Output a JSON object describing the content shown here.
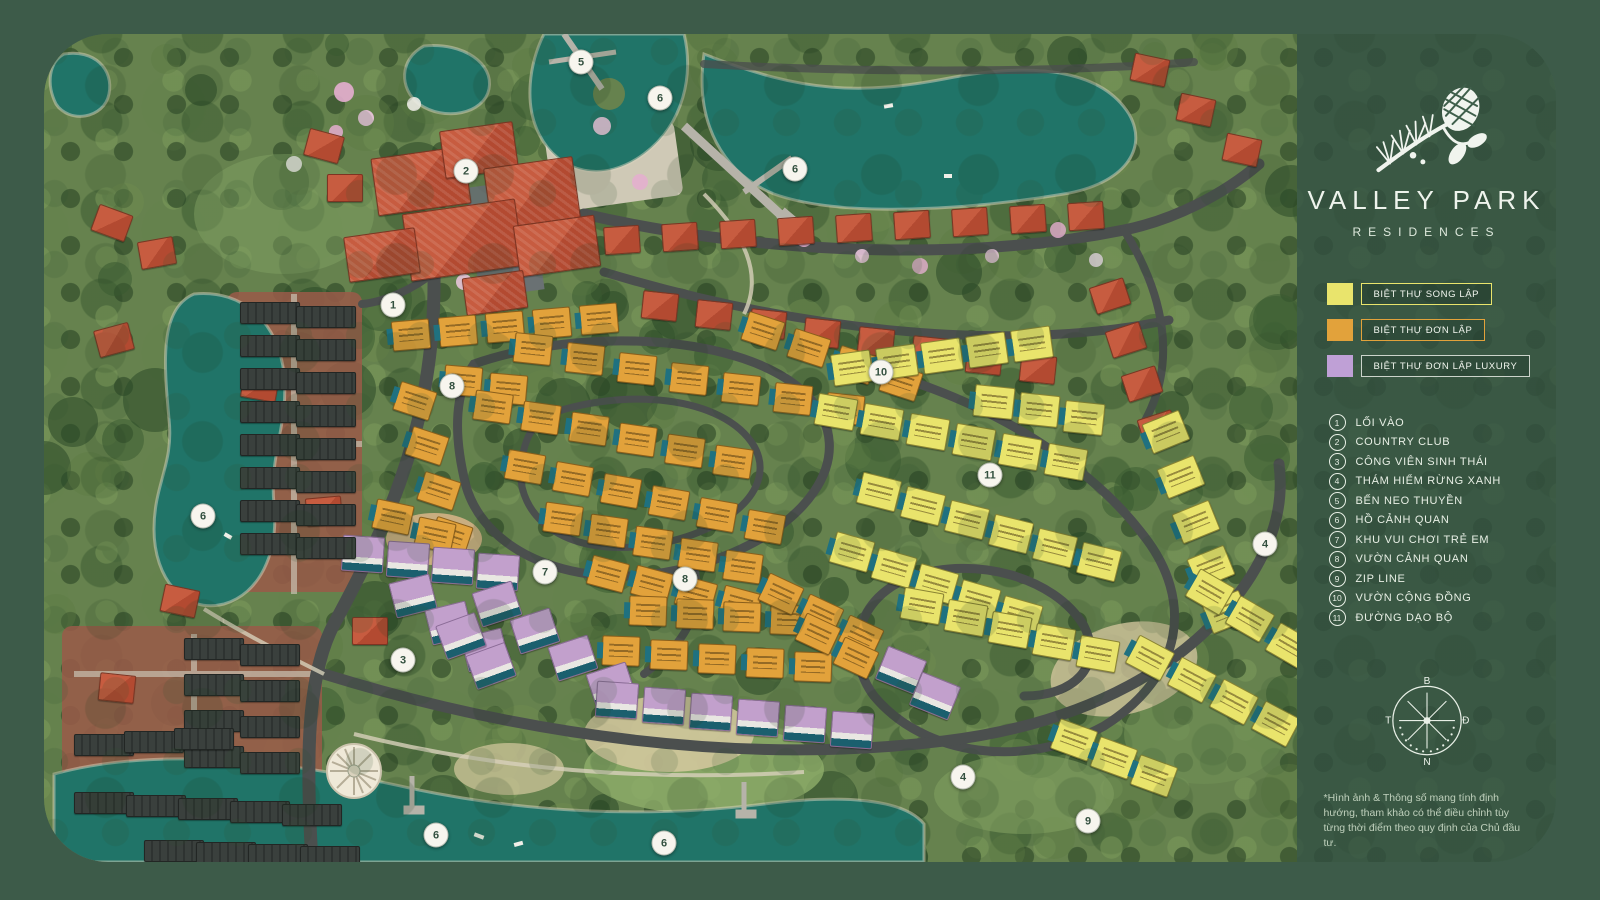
{
  "brand": {
    "logo": "pine-branch-and-cone",
    "title": "VALLEY PARK",
    "subtitle": "RESIDENCES"
  },
  "legend": [
    {
      "label": "BIỆT THỰ SONG LẬP",
      "color": "#e9e46c",
      "border": "#e9e46c"
    },
    {
      "label": "BIỆT THỰ ĐƠN LẬP",
      "color": "#e2a23b",
      "border": "#e2a23b"
    },
    {
      "label": "BIỆT THỰ ĐƠN LẬP LUXURY",
      "color": "#bfa0d6",
      "border": "#ccd4cb"
    }
  ],
  "locations": [
    {
      "num": "1",
      "label": "LỐI VÀO"
    },
    {
      "num": "2",
      "label": "COUNTRY CLUB"
    },
    {
      "num": "3",
      "label": "CÔNG VIÊN SINH THÁI"
    },
    {
      "num": "4",
      "label": "THÁM HIỂM RỪNG XANH"
    },
    {
      "num": "5",
      "label": "BẾN NEO THUYỀN"
    },
    {
      "num": "6",
      "label": "HỒ CẢNH QUAN"
    },
    {
      "num": "7",
      "label": "KHU VUI CHƠI TRẺ EM"
    },
    {
      "num": "8",
      "label": "VƯỜN CẢNH QUAN"
    },
    {
      "num": "9",
      "label": "ZIP LINE"
    },
    {
      "num": "10",
      "label": "VƯỜN CỘNG ĐỒNG"
    },
    {
      "num": "11",
      "label": "ĐƯỜNG DẠO BỘ"
    }
  ],
  "compass": {
    "north": "B",
    "east": "Đ",
    "south": "N",
    "west": "T"
  },
  "disclaimer": "*Hình ảnh & Thông số mang tính định hướng, tham khảo có thể điều chỉnh tùy từng thời điểm theo quy định của Chủ đầu tư.",
  "map": {
    "plot_id_examples": [
      "BT02",
      "BT03",
      "BT04",
      "BT05",
      "BT10",
      "BT12",
      "BT13",
      "BT16",
      "BT17"
    ],
    "markers": [
      {
        "n": "1",
        "x": 349,
        "y": 271
      },
      {
        "n": "2",
        "x": 422,
        "y": 137
      },
      {
        "n": "3",
        "x": 359,
        "y": 626
      },
      {
        "n": "4",
        "x": 1221,
        "y": 510
      },
      {
        "n": "4",
        "x": 919,
        "y": 743
      },
      {
        "n": "5",
        "x": 537,
        "y": 28
      },
      {
        "n": "6",
        "x": 616,
        "y": 64
      },
      {
        "n": "6",
        "x": 751,
        "y": 135
      },
      {
        "n": "6",
        "x": 159,
        "y": 482
      },
      {
        "n": "6",
        "x": 392,
        "y": 801
      },
      {
        "n": "6",
        "x": 620,
        "y": 809
      },
      {
        "n": "7",
        "x": 501,
        "y": 538
      },
      {
        "n": "8",
        "x": 408,
        "y": 352
      },
      {
        "n": "8",
        "x": 641,
        "y": 545
      },
      {
        "n": "9",
        "x": 1044,
        "y": 787
      },
      {
        "n": "10",
        "x": 837,
        "y": 338
      },
      {
        "n": "11",
        "x": 946,
        "y": 441
      }
    ],
    "strips": [
      {
        "c": "r",
        "x": 560,
        "y": 192,
        "dx": 58,
        "dy": -3,
        "n": 9,
        "r": -4
      },
      {
        "c": "r",
        "x": 598,
        "y": 258,
        "dx": 54,
        "dy": 9,
        "n": 8,
        "r": 6
      },
      {
        "c": "r",
        "x": 1048,
        "y": 248,
        "dx": 16,
        "dy": 44,
        "n": 4,
        "r": -18
      },
      {
        "c": "r",
        "x": 1088,
        "y": 22,
        "dx": 46,
        "dy": 40,
        "n": 3,
        "r": 12
      },
      {
        "c": "r",
        "x": 50,
        "y": 175,
        "dx": 0,
        "dy": 0,
        "n": 1,
        "r": 20
      },
      {
        "c": "r",
        "x": 95,
        "y": 205,
        "dx": 0,
        "dy": 0,
        "n": 1,
        "r": -10
      },
      {
        "c": "r",
        "x": 262,
        "y": 98,
        "dx": 0,
        "dy": 0,
        "n": 1,
        "r": 15
      },
      {
        "c": "r",
        "x": 283,
        "y": 140,
        "dx": 0,
        "dy": 0,
        "n": 1,
        "r": 0
      },
      {
        "c": "r",
        "x": 52,
        "y": 292,
        "dx": 0,
        "dy": 0,
        "n": 1,
        "r": -15
      },
      {
        "c": "r",
        "x": 198,
        "y": 338,
        "dx": 0,
        "dy": 0,
        "n": 1,
        "r": 10
      },
      {
        "c": "r",
        "x": 262,
        "y": 463,
        "dx": 0,
        "dy": 0,
        "n": 1,
        "r": -5
      },
      {
        "c": "r",
        "x": 118,
        "y": 553,
        "dx": 0,
        "dy": 0,
        "n": 1,
        "r": 12
      },
      {
        "c": "r",
        "x": 308,
        "y": 583,
        "dx": 0,
        "dy": 0,
        "n": 1,
        "r": 0
      },
      {
        "c": "r",
        "x": 150,
        "y": 688,
        "dx": 0,
        "dy": 0,
        "n": 1,
        "r": -8
      },
      {
        "c": "r",
        "x": 55,
        "y": 640,
        "dx": 0,
        "dy": 0,
        "n": 1,
        "r": 6
      },
      {
        "c": "c",
        "x": 330,
        "y": 118,
        "dx": 0,
        "dy": 0,
        "n": 1,
        "r": -8,
        "w": 92,
        "h": 56
      },
      {
        "c": "c",
        "x": 398,
        "y": 92,
        "dx": 0,
        "dy": 0,
        "n": 1,
        "r": -8,
        "w": 72,
        "h": 46
      },
      {
        "c": "c",
        "x": 443,
        "y": 128,
        "dx": 0,
        "dy": 0,
        "n": 1,
        "r": -8,
        "w": 88,
        "h": 60
      },
      {
        "c": "c",
        "x": 362,
        "y": 172,
        "dx": 0,
        "dy": 0,
        "n": 1,
        "r": -8,
        "w": 112,
        "h": 66
      },
      {
        "c": "c",
        "x": 472,
        "y": 186,
        "dx": 0,
        "dy": 0,
        "n": 1,
        "r": -8,
        "w": 80,
        "h": 50
      },
      {
        "c": "c",
        "x": 302,
        "y": 198,
        "dx": 0,
        "dy": 0,
        "n": 1,
        "r": -8,
        "w": 70,
        "h": 44
      },
      {
        "c": "c",
        "x": 420,
        "y": 240,
        "dx": 0,
        "dy": 0,
        "n": 1,
        "r": -8,
        "w": 60,
        "h": 36
      },
      {
        "c": "o",
        "x": 348,
        "y": 286,
        "dx": 47,
        "dy": -4,
        "n": 5,
        "r": -5
      },
      {
        "c": "o",
        "x": 400,
        "y": 332,
        "dx": 45,
        "dy": 8,
        "n": 2,
        "r": 5
      },
      {
        "c": "o",
        "x": 352,
        "y": 352,
        "dx": 12,
        "dy": 45,
        "n": 4,
        "r": 18
      },
      {
        "c": "o",
        "x": 470,
        "y": 300,
        "dx": 52,
        "dy": 10,
        "n": 7,
        "r": 6
      },
      {
        "c": "o",
        "x": 430,
        "y": 358,
        "dx": 48,
        "dy": 11,
        "n": 6,
        "r": 8
      },
      {
        "c": "o",
        "x": 462,
        "y": 418,
        "dx": 48,
        "dy": 12,
        "n": 6,
        "r": 10
      },
      {
        "c": "o",
        "x": 500,
        "y": 470,
        "dx": 45,
        "dy": 12,
        "n": 5,
        "r": 8
      },
      {
        "c": "o",
        "x": 330,
        "y": 468,
        "dx": 42,
        "dy": 18,
        "n": 2,
        "r": 12
      },
      {
        "c": "o",
        "x": 545,
        "y": 525,
        "dx": 44,
        "dy": 10,
        "n": 4,
        "r": 15
      },
      {
        "c": "o",
        "x": 700,
        "y": 282,
        "dx": 46,
        "dy": 17,
        "n": 4,
        "r": 18
      },
      {
        "c": "o",
        "x": 585,
        "y": 562,
        "dx": 47,
        "dy": 3,
        "n": 4,
        "r": 2
      },
      {
        "c": "o",
        "x": 558,
        "y": 602,
        "dx": 48,
        "dy": 4,
        "n": 5,
        "r": 2
      },
      {
        "c": "o",
        "x": 718,
        "y": 545,
        "dx": 40,
        "dy": 21,
        "n": 3,
        "r": 25
      },
      {
        "c": "o",
        "x": 755,
        "y": 585,
        "dx": 38,
        "dy": 24,
        "n": 2,
        "r": 25
      },
      {
        "c": "y",
        "x": 788,
        "y": 318,
        "dx": 45,
        "dy": -6,
        "n": 5,
        "r": -8
      },
      {
        "c": "y",
        "x": 930,
        "y": 352,
        "dx": 45,
        "dy": 8,
        "n": 3,
        "r": 6
      },
      {
        "c": "y",
        "x": 772,
        "y": 362,
        "dx": 46,
        "dy": 10,
        "n": 6,
        "r": 10
      },
      {
        "c": "y",
        "x": 815,
        "y": 442,
        "dx": 44,
        "dy": 14,
        "n": 6,
        "r": 14
      },
      {
        "c": "y",
        "x": 788,
        "y": 502,
        "dx": 42,
        "dy": 16,
        "n": 5,
        "r": 16
      },
      {
        "c": "y",
        "x": 858,
        "y": 556,
        "dx": 44,
        "dy": 12,
        "n": 5,
        "r": 10
      },
      {
        "c": "y",
        "x": 1102,
        "y": 382,
        "dx": 15,
        "dy": 45,
        "n": 5,
        "r": -22
      },
      {
        "c": "y",
        "x": 1086,
        "y": 608,
        "dx": 42,
        "dy": 22,
        "n": 4,
        "r": 28
      },
      {
        "c": "y",
        "x": 1146,
        "y": 542,
        "dx": 40,
        "dy": 27,
        "n": 3,
        "r": 30
      },
      {
        "c": "y",
        "x": 1010,
        "y": 690,
        "dx": 40,
        "dy": 18,
        "n": 3,
        "r": 20
      },
      {
        "c": "p",
        "x": 298,
        "y": 502,
        "dx": 45,
        "dy": 6,
        "n": 4,
        "r": 4
      },
      {
        "c": "p",
        "x": 348,
        "y": 544,
        "dx": 36,
        "dy": 27,
        "n": 3,
        "r": -14
      },
      {
        "c": "p",
        "x": 432,
        "y": 552,
        "dx": 38,
        "dy": 27,
        "n": 4,
        "r": -18
      },
      {
        "c": "p",
        "x": 396,
        "y": 584,
        "dx": 30,
        "dy": 30,
        "n": 2,
        "r": -20
      },
      {
        "c": "p",
        "x": 552,
        "y": 648,
        "dx": 47,
        "dy": 6,
        "n": 6,
        "r": 4
      },
      {
        "c": "p",
        "x": 836,
        "y": 618,
        "dx": 34,
        "dy": 26,
        "n": 2,
        "r": 22
      },
      {
        "c": "d",
        "x": 196,
        "y": 268,
        "dx": 0,
        "dy": 33,
        "n": 8,
        "r": 0
      },
      {
        "c": "d",
        "x": 252,
        "y": 272,
        "dx": 0,
        "dy": 33,
        "n": 8,
        "r": 0
      },
      {
        "c": "d",
        "x": 140,
        "y": 604,
        "dx": 0,
        "dy": 36,
        "n": 4,
        "r": 0
      },
      {
        "c": "d",
        "x": 196,
        "y": 610,
        "dx": 0,
        "dy": 36,
        "n": 4,
        "r": 0
      },
      {
        "c": "d",
        "x": 30,
        "y": 700,
        "dx": 50,
        "dy": -3,
        "n": 3,
        "r": 0
      },
      {
        "c": "d",
        "x": 30,
        "y": 758,
        "dx": 52,
        "dy": 3,
        "n": 5,
        "r": 0
      },
      {
        "c": "d",
        "x": 100,
        "y": 806,
        "dx": 52,
        "dy": 2,
        "n": 4,
        "r": 0
      }
    ]
  }
}
